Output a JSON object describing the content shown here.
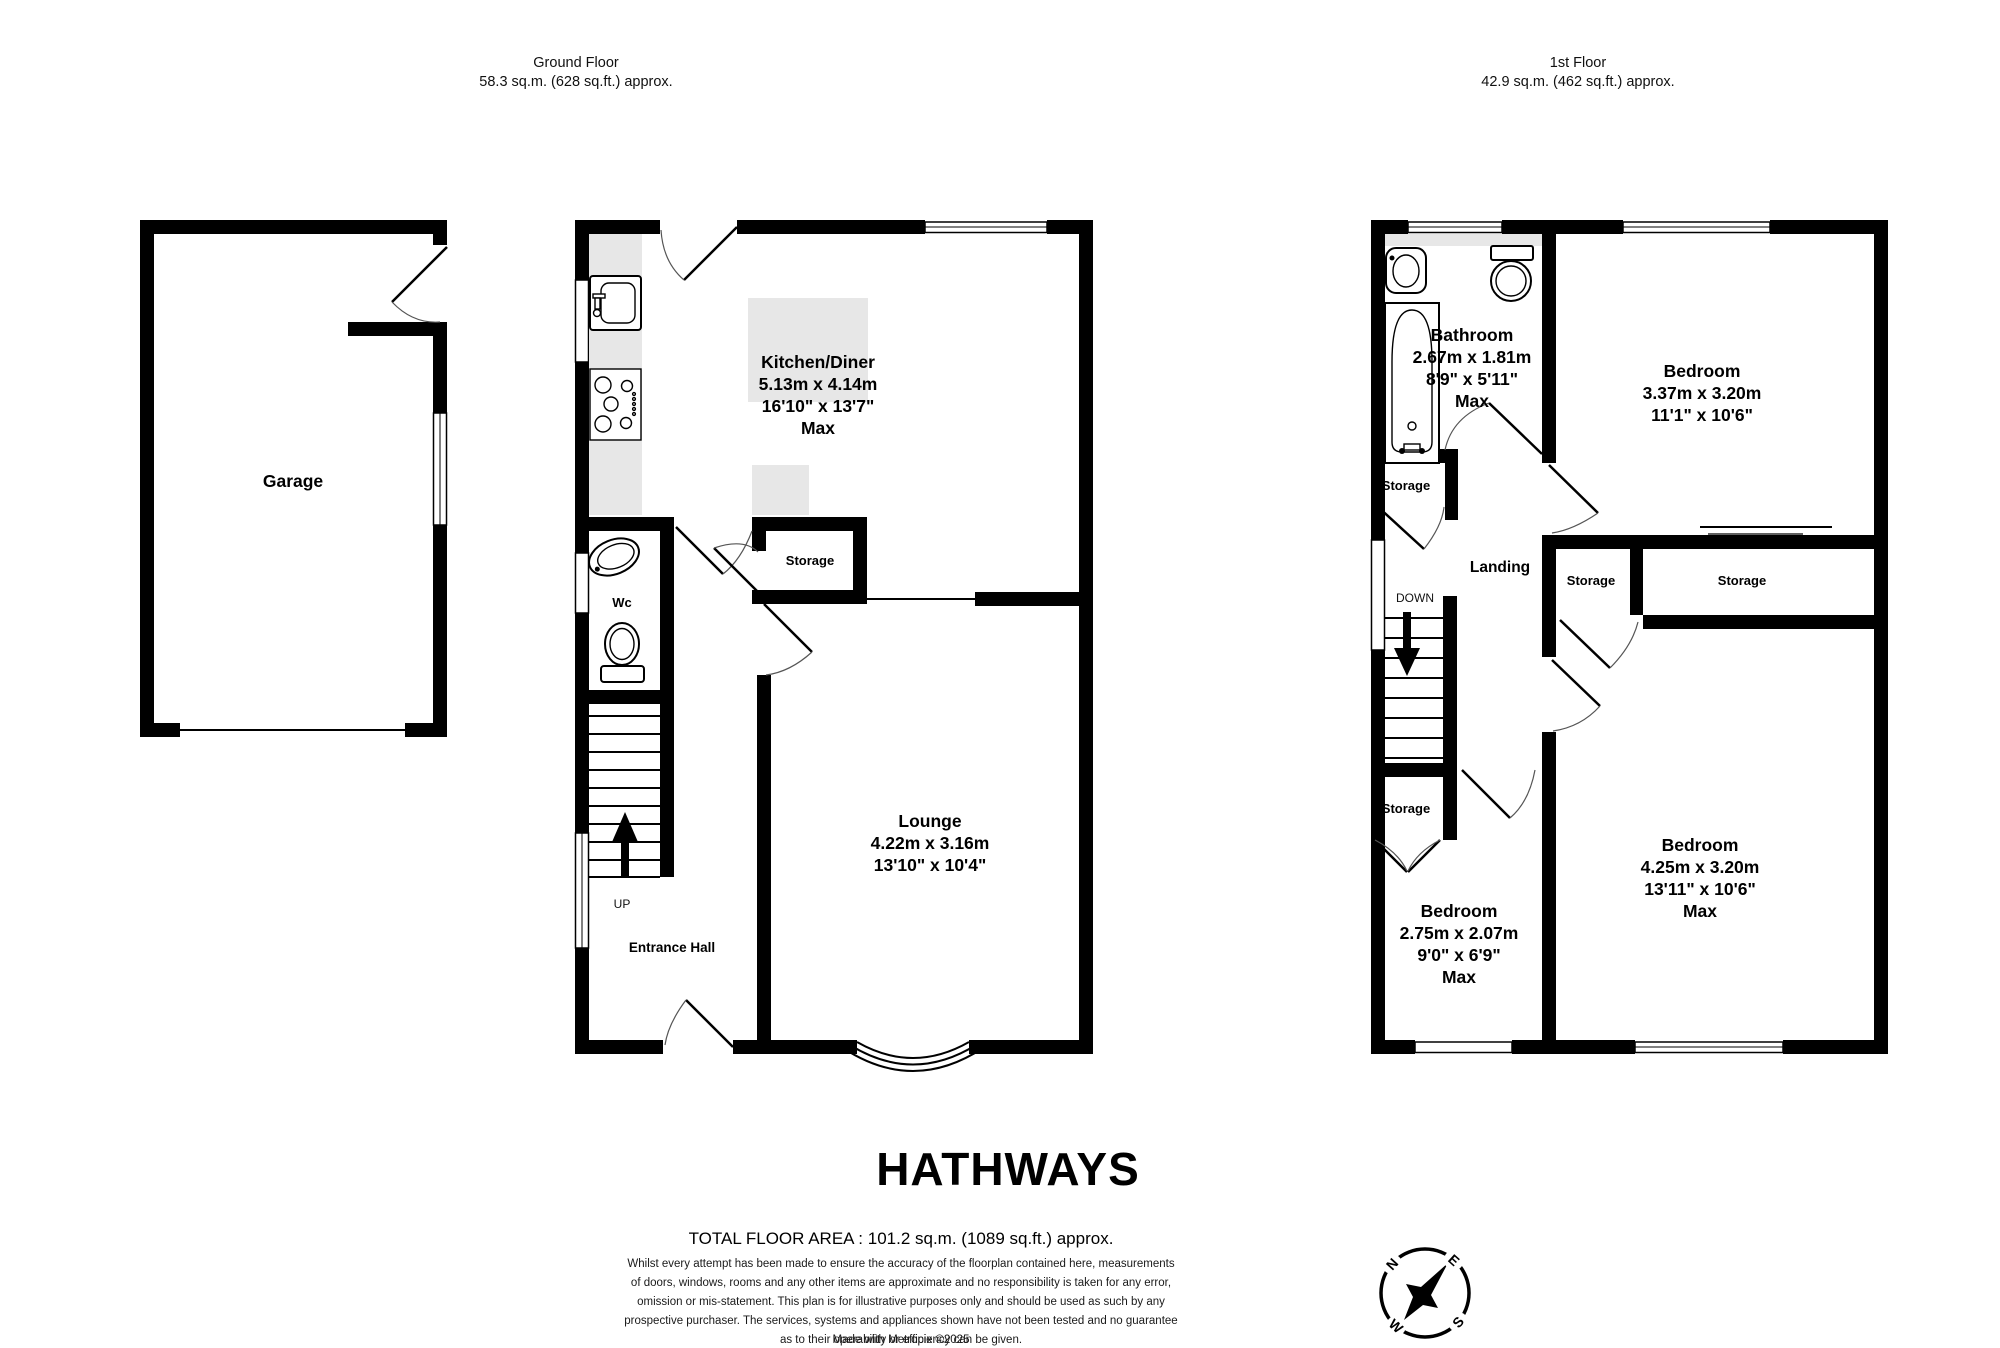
{
  "floors": {
    "ground": {
      "title": "Ground Floor",
      "area": "58.3 sq.m. (628 sq.ft.) approx."
    },
    "first": {
      "title": "1st Floor",
      "area": "42.9 sq.m. (462 sq.ft.) approx."
    }
  },
  "rooms": {
    "garage": {
      "name": "Garage"
    },
    "kitchen": {
      "name": "Kitchen/Diner",
      "metric": "5.13m  x 4.14m",
      "imperial": "16'10\"  x 13'7\"",
      "max": "Max"
    },
    "lounge": {
      "name": "Lounge",
      "metric": "4.22m  x 3.16m",
      "imperial": "13'10\"  x 10'4\""
    },
    "entrance_hall": {
      "name": "Entrance Hall"
    },
    "wc": {
      "name": "Wc"
    },
    "storage_gf": {
      "name": "Storage"
    },
    "bathroom": {
      "name": "Bathroom",
      "metric": "2.67m  x 1.81m",
      "imperial": "8'9\"  x 5'11\"",
      "max": "Max"
    },
    "bedroom1": {
      "name": "Bedroom",
      "metric": "3.37m  x 3.20m",
      "imperial": "11'1\"  x 10'6\""
    },
    "bedroom2": {
      "name": "Bedroom",
      "metric": "4.25m  x 3.20m",
      "imperial": "13'11\"  x 10'6\"",
      "max": "Max"
    },
    "bedroom3": {
      "name": "Bedroom",
      "metric": "2.75m  x 2.07m",
      "imperial": "9'0\"  x 6'9\"",
      "max": "Max"
    },
    "landing": {
      "name": "Landing"
    },
    "storage_bath": {
      "name": "Storage"
    },
    "storage_mid": {
      "name": "Storage"
    },
    "storage_right": {
      "name": "Storage"
    },
    "storage_under_stairs": {
      "name": "Storage"
    }
  },
  "stairs": {
    "up": "UP",
    "down": "DOWN"
  },
  "branding": {
    "logo": "HATHWAYS",
    "logo_color": "#6b5b9e"
  },
  "footer": {
    "total": "TOTAL FLOOR AREA : 101.2 sq.m. (1089 sq.ft.) approx.",
    "disclaimer": [
      "Whilst every attempt has been made to ensure the accuracy of the floorplan contained here, measurements",
      "of doors, windows, rooms and any other items are approximate and no responsibility is taken for any error,",
      "omission or mis-statement. This plan is for illustrative purposes only and should be used as such by any",
      "prospective purchaser. The services, systems and appliances shown have not been tested and no guarantee",
      "as to their operability or efficiency can be given."
    ],
    "credit": "Made with Metropix ©2025"
  },
  "compass": {
    "n": "N",
    "e": "E",
    "s": "S",
    "w": "W"
  }
}
